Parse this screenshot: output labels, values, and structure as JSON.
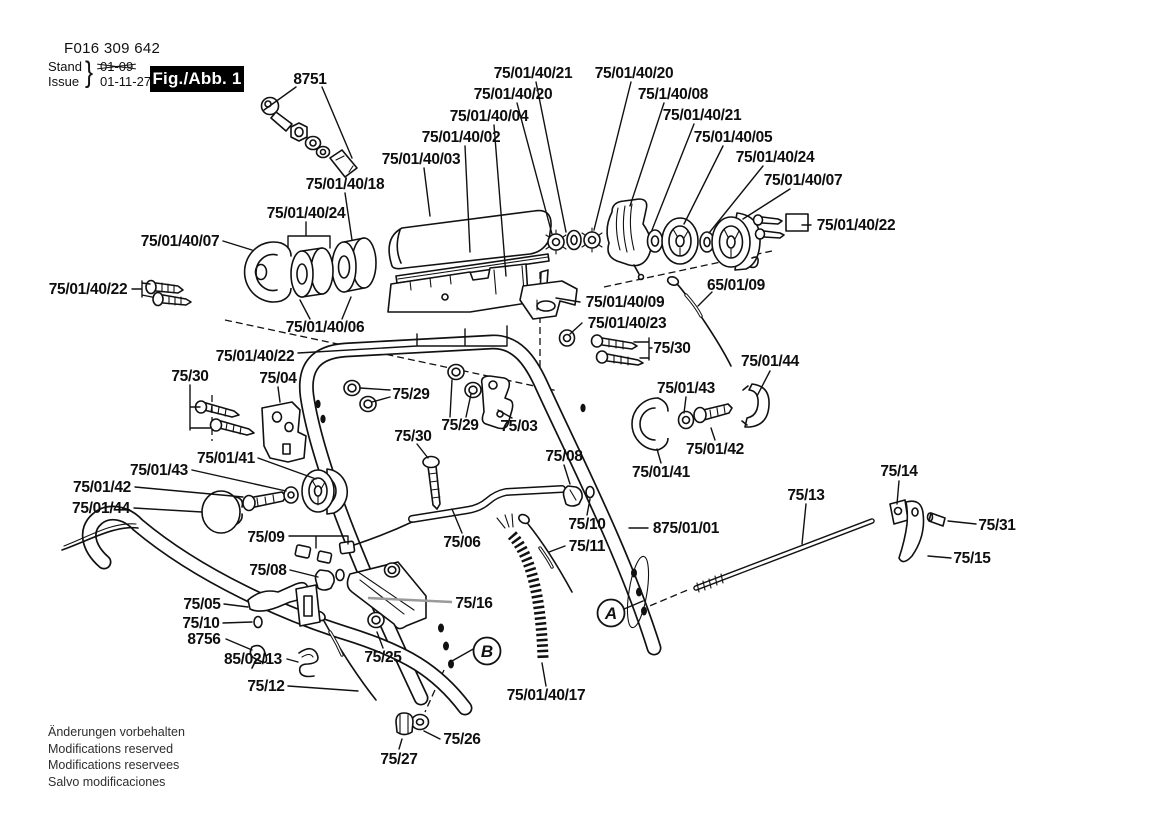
{
  "header": {
    "doc_number": "F016 309 642",
    "stand_label": "Stand",
    "issue_label": "Issue",
    "brace": "}",
    "old_date": "01-09",
    "date": "01-11-27",
    "fig_label": "Fig./Abb. 1"
  },
  "footer": {
    "lines": [
      "Änderungen vorbehalten",
      "Modifications reserved",
      "Modifications reservees",
      "Salvo modificaciones"
    ]
  },
  "colors": {
    "ink": "#111111",
    "paper": "#ffffff"
  },
  "diagram": {
    "labels": [
      {
        "text": "8751",
        "x": 310,
        "y": 79
      },
      {
        "text": "75/01/40/21",
        "x": 533,
        "y": 73
      },
      {
        "text": "75/01/40/20",
        "x": 634,
        "y": 73
      },
      {
        "text": "75/01/40/20",
        "x": 513,
        "y": 94
      },
      {
        "text": "75/1/40/08",
        "x": 673,
        "y": 94
      },
      {
        "text": "75/01/40/21",
        "x": 702,
        "y": 115
      },
      {
        "text": "75/01/40/04",
        "x": 489,
        "y": 116
      },
      {
        "text": "75/01/40/05",
        "x": 733,
        "y": 137
      },
      {
        "text": "75/01/40/02",
        "x": 461,
        "y": 137
      },
      {
        "text": "75/01/40/24",
        "x": 775,
        "y": 157
      },
      {
        "text": "75/01/40/03",
        "x": 421,
        "y": 159
      },
      {
        "text": "75/01/40/07",
        "x": 803,
        "y": 180
      },
      {
        "text": "75/01/40/18",
        "x": 345,
        "y": 184
      },
      {
        "text": "75/01/40/24",
        "x": 306,
        "y": 213
      },
      {
        "text": "75/01/40/22",
        "x": 856,
        "y": 225
      },
      {
        "text": "75/01/40/07",
        "x": 180,
        "y": 241
      },
      {
        "text": "75/01/40/22",
        "x": 88,
        "y": 289
      },
      {
        "text": "75/01/40/06",
        "x": 325,
        "y": 327
      },
      {
        "text": "75/01/40/09",
        "x": 625,
        "y": 302
      },
      {
        "text": "65/01/09",
        "x": 736,
        "y": 285
      },
      {
        "text": "75/01/40/23",
        "x": 627,
        "y": 323
      },
      {
        "text": "75/30",
        "x": 672,
        "y": 348
      },
      {
        "text": "75/01/44",
        "x": 770,
        "y": 361
      },
      {
        "text": "75/01/43",
        "x": 686,
        "y": 388
      },
      {
        "text": "75/01/42",
        "x": 715,
        "y": 449
      },
      {
        "text": "75/01/41",
        "x": 661,
        "y": 472
      },
      {
        "text": "75/14",
        "x": 899,
        "y": 471
      },
      {
        "text": "75/13",
        "x": 806,
        "y": 495
      },
      {
        "text": "75/31",
        "x": 997,
        "y": 525
      },
      {
        "text": "75/15",
        "x": 972,
        "y": 558
      },
      {
        "text": "875/01/01",
        "x": 686,
        "y": 528
      },
      {
        "text": "75/08",
        "x": 564,
        "y": 456
      },
      {
        "text": "75/10",
        "x": 587,
        "y": 524
      },
      {
        "text": "75/11",
        "x": 587,
        "y": 546
      },
      {
        "text": "75/06",
        "x": 462,
        "y": 542
      },
      {
        "text": "75/29",
        "x": 411,
        "y": 394
      },
      {
        "text": "75/29",
        "x": 460,
        "y": 425
      },
      {
        "text": "75/03",
        "x": 519,
        "y": 426
      },
      {
        "text": "75/30",
        "x": 413,
        "y": 436
      },
      {
        "text": "75/04",
        "x": 278,
        "y": 378
      },
      {
        "text": "75/30",
        "x": 190,
        "y": 376
      },
      {
        "text": "75/01/40/22",
        "x": 255,
        "y": 356
      },
      {
        "text": "75/01/41",
        "x": 226,
        "y": 458
      },
      {
        "text": "75/01/43",
        "x": 159,
        "y": 470
      },
      {
        "text": "75/01/42",
        "x": 102,
        "y": 487
      },
      {
        "text": "75/01/44",
        "x": 101,
        "y": 508
      },
      {
        "text": "75/09",
        "x": 266,
        "y": 537
      },
      {
        "text": "75/08",
        "x": 268,
        "y": 570
      },
      {
        "text": "75/05",
        "x": 202,
        "y": 604
      },
      {
        "text": "75/10",
        "x": 201,
        "y": 623
      },
      {
        "text": "8756",
        "x": 204,
        "y": 639
      },
      {
        "text": "85/02/13",
        "x": 253,
        "y": 659
      },
      {
        "text": "75/12",
        "x": 266,
        "y": 686
      },
      {
        "text": "75/16",
        "x": 474,
        "y": 603
      },
      {
        "text": "75/25",
        "x": 383,
        "y": 657
      },
      {
        "text": "75/26",
        "x": 462,
        "y": 739
      },
      {
        "text": "75/27",
        "x": 399,
        "y": 759
      },
      {
        "text": "75/01/40/17",
        "x": 546,
        "y": 695
      }
    ],
    "callouts": [
      {
        "id": "A",
        "x": 611,
        "y": 613
      },
      {
        "id": "B",
        "x": 487,
        "y": 651
      }
    ]
  }
}
